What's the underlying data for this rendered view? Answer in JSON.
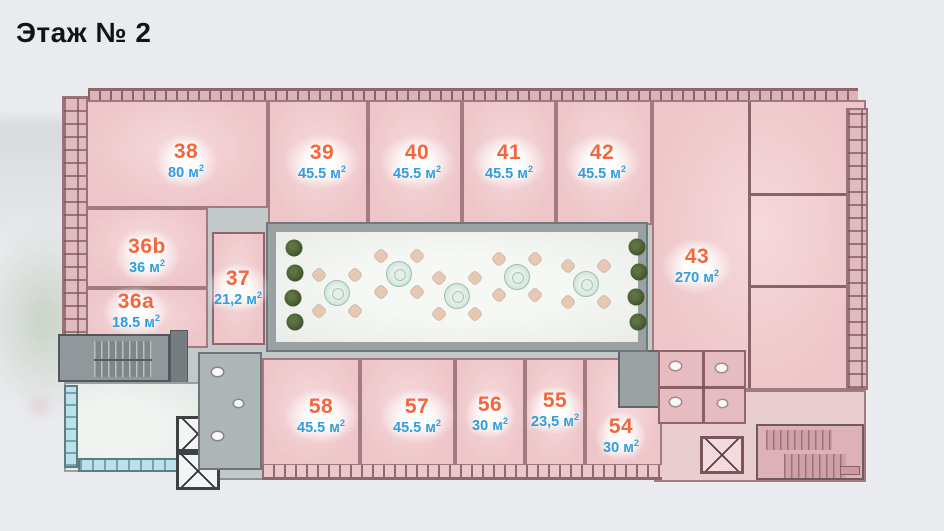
{
  "header": {
    "title": "Этаж № 2"
  },
  "colors": {
    "unit_number": "#f4663c",
    "unit_area": "#2e9ede",
    "room_fill": "#eec6c9",
    "wall": "#8f666d",
    "corridor": "#c3c8c8",
    "courtyard_floor": "#f2f4f1",
    "glass": "#b9e2ea",
    "background": "#e9ebee",
    "title_text": "#101318"
  },
  "plan": {
    "floor_label": "Этаж № 2",
    "units": [
      {
        "number": "38",
        "area": "80 м",
        "sup": "2"
      },
      {
        "number": "39",
        "area": "45.5 м",
        "sup": "2"
      },
      {
        "number": "40",
        "area": "45.5 м",
        "sup": "2"
      },
      {
        "number": "41",
        "area": "45.5 м",
        "sup": "2"
      },
      {
        "number": "42",
        "area": "45.5 м",
        "sup": "2"
      },
      {
        "number": "36b",
        "area": "36 м",
        "sup": "2"
      },
      {
        "number": "36a",
        "area": "18.5 м",
        "sup": "2"
      },
      {
        "number": "37",
        "area": "21,2 м",
        "sup": "2"
      },
      {
        "number": "43",
        "area": "270 м",
        "sup": "2"
      },
      {
        "number": "58",
        "area": "45.5 м",
        "sup": "2"
      },
      {
        "number": "57",
        "area": "45.5 м",
        "sup": "2"
      },
      {
        "number": "56",
        "area": "30 м",
        "sup": "2"
      },
      {
        "number": "55",
        "area": "23,5 м",
        "sup": "2"
      },
      {
        "number": "54",
        "area": "30 м",
        "sup": "2"
      }
    ]
  }
}
